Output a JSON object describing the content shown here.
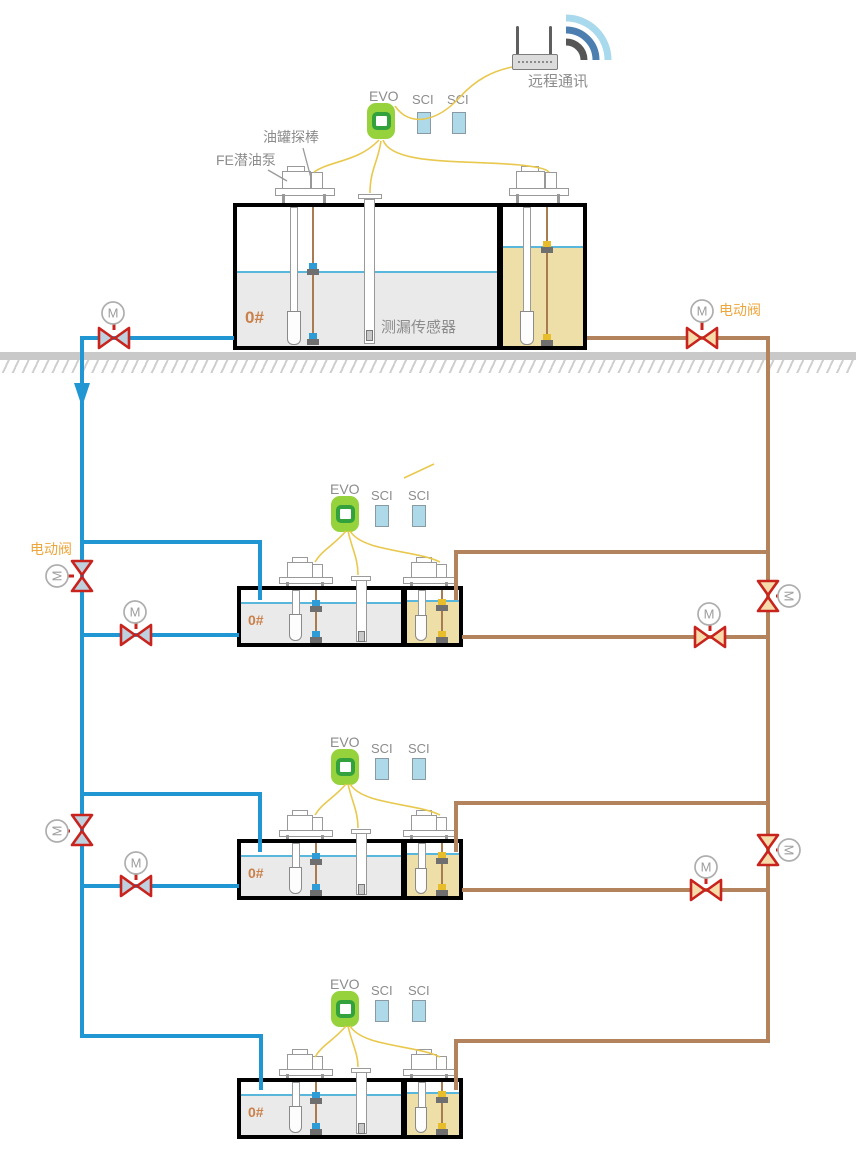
{
  "header": {
    "remote_comm_label": "远程通讯"
  },
  "devices": {
    "controller_label": "EVO",
    "interface_label": "SCI",
    "motor": "M"
  },
  "annotations": {
    "tank_probe": "油罐探棒",
    "fe_pump": "FE潜油泵",
    "leak_sensor": "测漏传感器",
    "electric_valve": "电动阀"
  },
  "tanks": [
    {
      "grade": "0#"
    },
    {
      "grade": "0#"
    },
    {
      "grade": "0#"
    },
    {
      "grade": "0#"
    }
  ],
  "colors": {
    "supply_pipe_blue": "#2097d3",
    "return_pipe_brown": "#b2835c",
    "signal_wire_yellow": "#e9c84e",
    "valve_red": "#c8231d",
    "valve_fill_blue_side": "#bed1df",
    "valve_fill_brown_side": "#f6dcaa",
    "controller_green": "#95d23c",
    "interface_blue": "#aed9e8",
    "diesel_fill_gray": "#eaeaea",
    "gasoline_fill_tan": "#eedfa8",
    "liquid_surface_blue": "#58b7da",
    "label_gray": "#8c8c8c",
    "label_orange": "#eda63c",
    "ground_gray": "#c9c9c9"
  }
}
